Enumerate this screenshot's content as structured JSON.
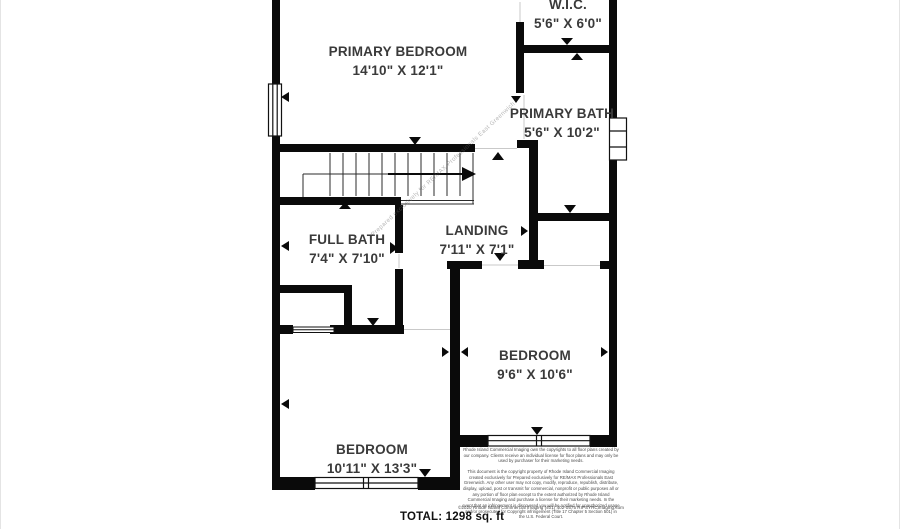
{
  "rooms": [
    {
      "name": "PRIMARY BEDROOM",
      "dims": "14'10\" X 12'1\""
    },
    {
      "name": "W.I.C.",
      "dims": "5'6\" X 6'0\""
    },
    {
      "name": "PRIMARY BATH",
      "dims": "5'6\" X 10'2\""
    },
    {
      "name": "LANDING",
      "dims": "7'11\" X 7'1\""
    },
    {
      "name": "FULL BATH",
      "dims": "7'4\" X 7'10\""
    },
    {
      "name": "BEDROOM",
      "dims": "9'6\" X 10'6\""
    },
    {
      "name": "BEDROOM",
      "dims": "10'11\" X 13'3\""
    }
  ],
  "total_label": "TOTAL: 1298 sq. ft",
  "watermark": "Prepared exclusively for RE/MAX Professionals East Greenwich",
  "copyright": {
    "license_note": "Rhode Island Commercial Imaging own the copyrights to all floor plans created by our company. Clients receive an individual license for floor plans and may only be used by purchaser for their marketing needs.",
    "legal_note": "This document is the copyright property of Rhode Island Commercial Imaging created exclusively for Prepared exclusively for RE/MAX Professionals East Greenwich. Any other user may not copy, modify, reproduce, republish, distribute, display, upload, post or transmit for commercial, nonprofit or public purposes all or any portion of floor plan except to the extent authorized by Rhode Island Commercial Imaging and purchase a license for their marketing needs. In the event that an infringement is discovered you will be notified for unauthorized usage and/or prosecuted for Copyright infringement (Title 17 Chapter 5 Section 501) in the U.S. Federal Court.",
    "footer_line": "©2020 Rhode Island Commercial Imaging (401) 402-0575 RIPSYRCImaging.com"
  },
  "colors": {
    "wall": "#0a0a0a",
    "background": "#ffffff",
    "label_text": "#3a3a3a"
  }
}
